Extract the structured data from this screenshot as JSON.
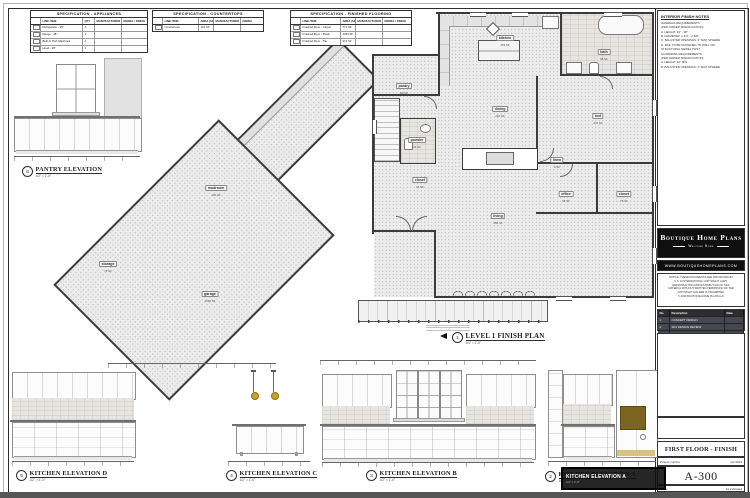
{
  "palette": {
    "band": "#565656",
    "gold": "#c9a227",
    "olive": "#7a6420",
    "logo_bg": "#0f0f0f"
  },
  "tables": {
    "appliances": {
      "title": "SPECIFICATION - APPLIANCES",
      "headers": [
        "",
        "LINE ITEM",
        "QTY",
        "MANUFACTURER",
        "MODEL / FINISH"
      ],
      "rows": [
        [
          "Refrigerator - 36\"",
          "1"
        ],
        [
          "Range - 48\"",
          "1"
        ],
        [
          "Built-In Dish Machines",
          "2"
        ],
        [
          "Hood - 48\"",
          "1"
        ]
      ]
    },
    "countertops": {
      "title": "SPECIFICATION - COUNTERTOPS",
      "headers": [
        "",
        "LINE ITEM",
        "AREA (SF)",
        "MANUFACTURER",
        "FINISH"
      ],
      "rows": [
        [
          "Countertops",
          "131 SF"
        ]
      ]
    },
    "flooring": {
      "title": "SPECIFICATION - FINISHED FLOORING",
      "headers": [
        "",
        "LINE ITEM",
        "AREA (SF)",
        "MANUFACTURER",
        "MODEL / FINISH"
      ],
      "rows": [
        [
          "Finished Floor - Carpet",
          "771 SF"
        ],
        [
          "Finished Floor - Plank",
          "2453 SF"
        ],
        [
          "Finished Floor - Tile",
          "374 SF"
        ]
      ]
    }
  },
  "notes": {
    "title": "INTERIOR FINISH NOTES",
    "lines": [
      "HANDRAIL REQUIREMENTS:",
      "(PER OWNER SPECIFICATION)",
      "A.   HEIGHT: 34\" - 38\"",
      "B.   DIAMETER: 1-1/4\" - 2-5/8\"",
      "C.   BALUSTER OPENINGS: 4\" MAX SPHERE",
      "D.   RAIL TO BE FASTENED TO WALL OR",
      "      STRUCTURAL NEWEL POST",
      "",
      "GUARDRAIL REQUIREMENTS:",
      "(PER OWNER SPECIFICATION)",
      "A.   HEIGHT: 42\" MIN",
      "B.   BALUSTER OPENINGS: 4\" MAX SPHERE"
    ]
  },
  "plan": {
    "number": "1",
    "title": "LEVEL 1 FINISH PLAN",
    "scale": "1/4\" = 1'-0\"",
    "rooms": [
      {
        "name": "kitchen",
        "area": "253 SF"
      },
      {
        "name": "bath",
        "area": "68 SF"
      },
      {
        "name": "pantry",
        "area": "69 SF"
      },
      {
        "name": "dining",
        "area": "216 SF"
      },
      {
        "name": "bed",
        "area": "247 SF"
      },
      {
        "name": "linen",
        "area": "9 SF"
      },
      {
        "name": "powder",
        "area": "24 SF"
      },
      {
        "name": "living",
        "area": "366 SF"
      },
      {
        "name": "office",
        "area": "96 SF"
      },
      {
        "name": "closet",
        "area": "76 SF"
      },
      {
        "name": "mudroom",
        "area": "166 SF"
      },
      {
        "name": "storage",
        "area": "76 SF"
      },
      {
        "name": "garage",
        "area": "1046 SF"
      },
      {
        "name": "closet",
        "area": "14 SF"
      }
    ]
  },
  "elevations": {
    "pantry": {
      "number": "6",
      "title": "PANTRY ELEVATION",
      "scale": "1/2\" = 1'-0\""
    },
    "d": {
      "number": "5",
      "title": "KITCHEN ELEVATION D",
      "scale": "1/2\" = 1'-0\""
    },
    "c": {
      "number": "4",
      "title": "KITCHEN ELEVATION C",
      "scale": "1/2\" = 1'-0\""
    },
    "b": {
      "number": "3",
      "title": "KITCHEN ELEVATION B",
      "scale": "1/2\" = 1'-0\""
    },
    "a": {
      "number": "2",
      "title": "KITCHEN ELEVATION A",
      "scale": "1/2\" = 1'-0\""
    }
  },
  "selection": {
    "label": "KITCHEN ELEVATION A",
    "note": "1/2\" = 1'-0\""
  },
  "titleblock": {
    "brand": "Boutique Home Plans",
    "tagline": "Welcome Home",
    "website": "WWW.BOUTIQUEHOMEPLANS.COM",
    "notice_lines": [
      "NOTICE: THESE DOCUMENTS ARE PROTECTED BY",
      "U.S. & INTERNATIONAL COPYRIGHT LAWS.",
      "REPRODUCTION AND DISTRIBUTION OF THIS",
      "MATERIAL WITHOUT WRITTEN PERMISSION OF THE",
      "COPYRIGHT HOLDER IS PROHIBITED.",
      "© 2023 BOUTIQUE HOME PLANS LLC"
    ],
    "revisions": {
      "headers": [
        "No.",
        "Description",
        "Date"
      ],
      "rows": [
        [
          "1",
          "CONCEPT DESIGN",
          ""
        ],
        [
          "2",
          "SD1 DESIGN REVIEW",
          ""
        ],
        [
          "3",
          "SD2 DESIGN REVIEW",
          ""
        ]
      ]
    },
    "sheet_title": "FIRST FLOOR - FINISH PLAN",
    "project_label": "Project number",
    "project_value": "Q2 2023",
    "sheet_number": "A-300",
    "scale_label": "Scale",
    "scale_value": "As indicated"
  }
}
